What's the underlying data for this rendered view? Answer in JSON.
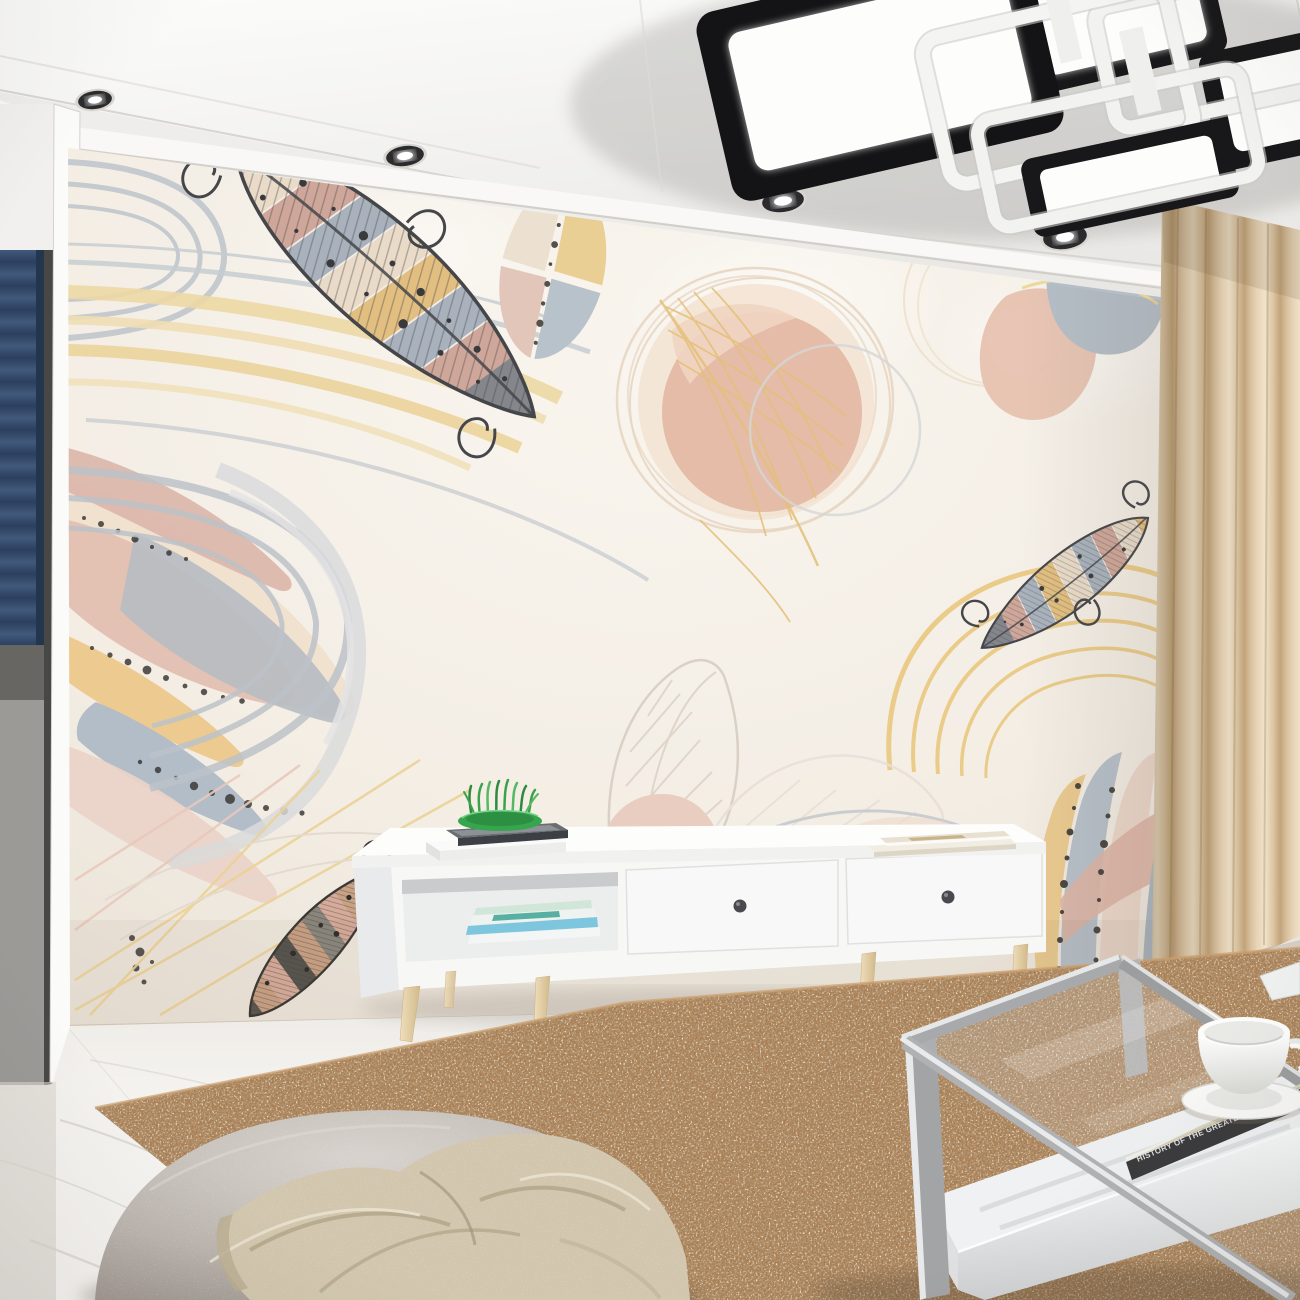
{
  "scene": {
    "room": "living-room",
    "kind": "interior-render",
    "wall_art": "pastel feathers and leaves mural"
  },
  "book": {
    "spine_title": "HISTORY OF THE GREATEST PLACES",
    "spine_author": "RICHARD HOCH"
  },
  "counts": {
    "recessed_spotlights": 4,
    "tv_stand_drawers": 2
  },
  "palette": {
    "ceiling": "#f6f5f3",
    "wall": "#f4efe8",
    "mural_yellow": "#e6c585",
    "mural_pink": "#dcb5a6",
    "mural_gray": "#aab4bd",
    "mural_salmon": "#e0b29c",
    "mural_outline": "#45464a",
    "curtain": "#ddc5a3",
    "rug": "#ab7d51",
    "marble_floor": "#f5f3f0",
    "tv_stand": "#f8f8f7",
    "wood_leg": "#e7d5ae",
    "pouf": "#bdb6b0",
    "blanket": "#d2c7ae",
    "table_frame": "#a8a9ab",
    "fixture_black": "#18181a",
    "fixture_white": "#f2f2f1",
    "plant_green": "#35a64e",
    "magazine_blue": "#7ec6dd"
  }
}
